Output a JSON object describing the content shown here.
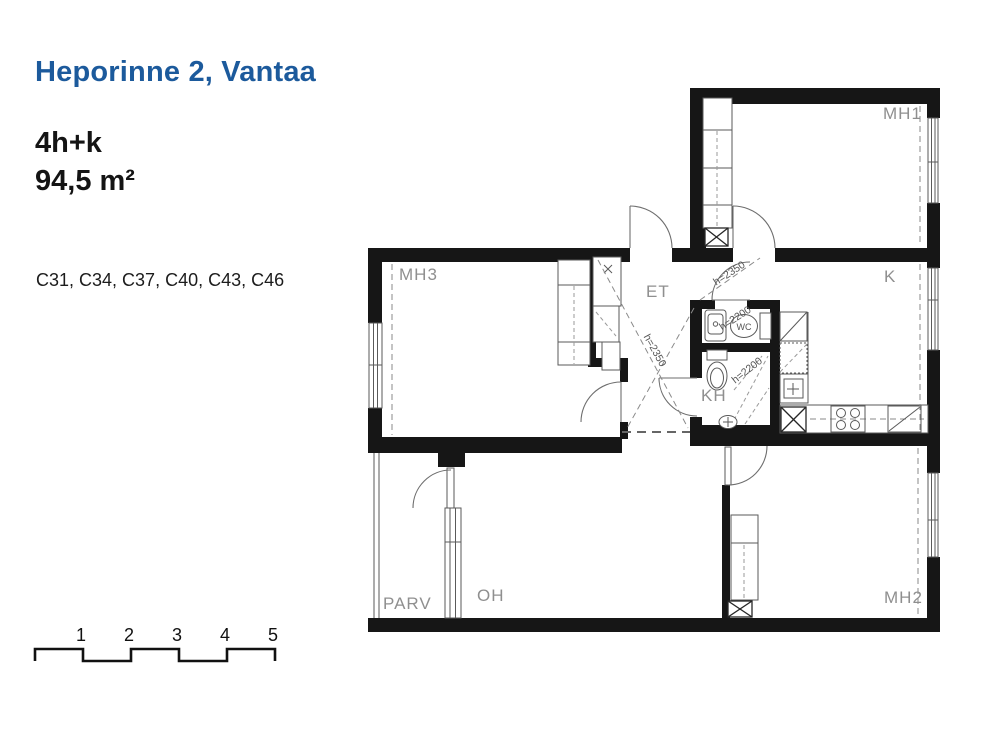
{
  "header": {
    "title": "Heporinne 2, Vantaa",
    "layout": "4h+k",
    "area": "94,5 m²",
    "units": "C31, C34, C37, C40, C43, C46"
  },
  "plan": {
    "rooms": {
      "mh1": "MH1",
      "mh2": "MH2",
      "mh3": "MH3",
      "k": "K",
      "et": "ET",
      "kh": "KH",
      "wc": "WC",
      "oh": "OH",
      "parv": "PARV"
    },
    "heights": {
      "et": "h=2350",
      "hall": "h=2350",
      "wc": "h=2200",
      "kh": "h=2200"
    }
  },
  "scale_bar": {
    "labels": [
      "1",
      "2",
      "3",
      "4",
      "5"
    ]
  },
  "colors": {
    "title_blue": "#1c5a9c",
    "wall_black": "#161616",
    "label_gray": "#8f8f8f"
  }
}
